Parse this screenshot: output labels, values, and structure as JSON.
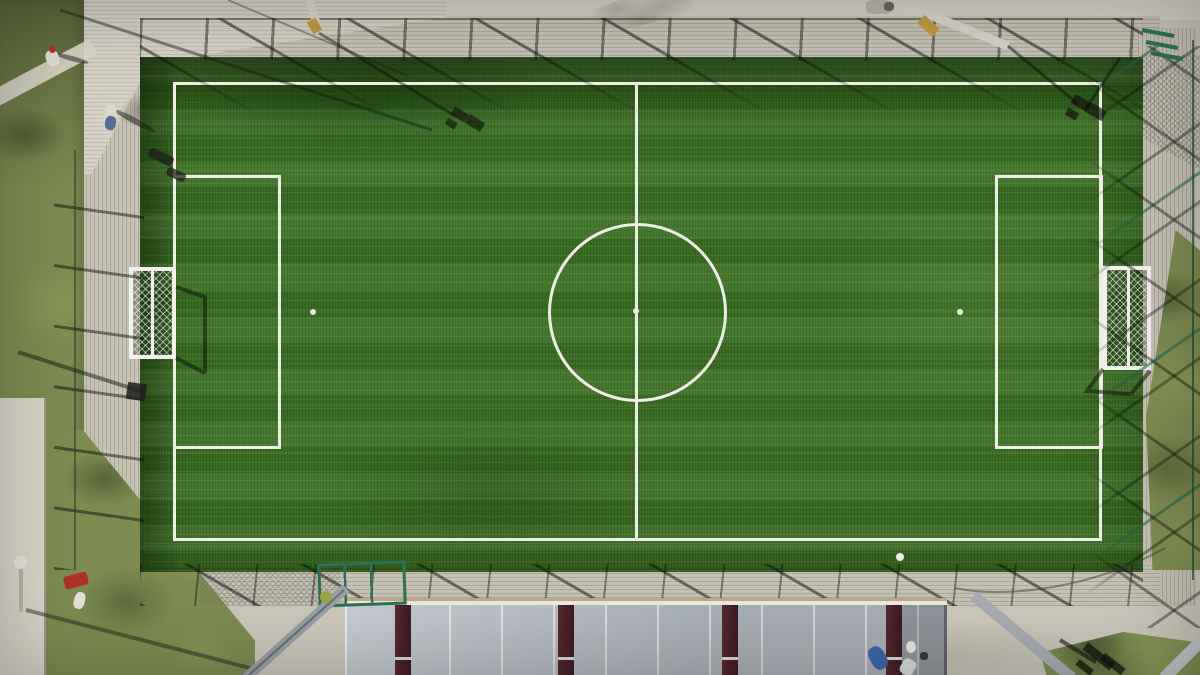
{
  "scene": {
    "description": "Top-down aerial drone photograph of an artificial-turf soccer pitch surrounded by a plank-textured concrete walkway, perimeter fences casting long diagonal shadows, lawn strips on the left and right, leaning floodlight masts, and a grey metal canopy roof with maroon beams along the bottom edge.",
    "field": {
      "bounds_px": {
        "left": 173,
        "top": 82,
        "right": 1102,
        "bottom": 541
      },
      "center_circle_radius_px": 89,
      "markings": [
        "touchlines",
        "halfway line",
        "center circle",
        "center spot",
        "left penalty area",
        "right penalty area",
        "left penalty spot",
        "right penalty spot",
        "left goal with net",
        "right goal with net"
      ]
    }
  },
  "colors": {
    "turf": "#3d7125",
    "line": "#edefe6",
    "goal": "#f2f3ec",
    "concrete": "#ccc8bc",
    "plaza": "#d6d2c6",
    "deck": "#c6c2b4",
    "path": "#dbd7ca",
    "grass": "#7e8c52",
    "roof": "#b7bec6",
    "fence_green": "#2d7057"
  },
  "objects": [
    {
      "name": "person-top-left-shadow",
      "x": 55,
      "y": 56,
      "w": 34,
      "h": 5,
      "color": "rgba(25,28,20,0.5)",
      "rotate": 15,
      "radius": "50%"
    },
    {
      "name": "person-top-left-shirt",
      "x": 46,
      "y": 50,
      "w": 13,
      "h": 16,
      "color": "#e3e1d6",
      "rotate": -20,
      "radius": "40%"
    },
    {
      "name": "person-top-left-cap",
      "x": 49,
      "y": 46,
      "w": 7,
      "h": 7,
      "color": "#b5352b",
      "radius": "50%"
    },
    {
      "name": "person-walkway-shadow",
      "x": 112,
      "y": 118,
      "w": 46,
      "h": 6,
      "color": "rgba(25,28,20,0.5)",
      "rotate": 28,
      "radius": "50%"
    },
    {
      "name": "person-walkway-body",
      "x": 104,
      "y": 104,
      "w": 12,
      "h": 26,
      "color": "#dad8cf",
      "rotate": 8,
      "radius": "40%"
    },
    {
      "name": "person-walkway-jacket",
      "x": 105,
      "y": 116,
      "w": 11,
      "h": 14,
      "color": "#5a6c96",
      "rotate": 8,
      "radius": "40%"
    },
    {
      "name": "bench-dark-1",
      "x": 148,
      "y": 152,
      "w": 26,
      "h": 10,
      "color": "rgba(30,32,26,0.8)",
      "rotate": 25,
      "radius": "3px"
    },
    {
      "name": "bench-dark-2",
      "x": 166,
      "y": 170,
      "w": 20,
      "h": 9,
      "color": "rgba(30,32,26,0.75)",
      "rotate": 25,
      "radius": "3px"
    },
    {
      "name": "bags-top-right",
      "x": 866,
      "y": 0,
      "w": 26,
      "h": 14,
      "color": "#b9b5a8",
      "radius": "30%"
    },
    {
      "name": "bag-dark-top-right",
      "x": 884,
      "y": 2,
      "w": 10,
      "h": 9,
      "color": "#6b675c",
      "radius": "40%"
    },
    {
      "name": "lamp-pole-bottom-left",
      "x": 19,
      "y": 566,
      "w": 4,
      "h": 46,
      "color": "#b9b6aa",
      "radius": "2px"
    },
    {
      "name": "lamp-head-bottom-left",
      "x": 14,
      "y": 556,
      "w": 13,
      "h": 13,
      "color": "#e8e6dd",
      "radius": "50%"
    },
    {
      "name": "red-utility-cart",
      "x": 64,
      "y": 574,
      "w": 24,
      "h": 13,
      "color": "#b03226",
      "rotate": -15,
      "radius": "3px"
    },
    {
      "name": "person-bottom-left",
      "x": 74,
      "y": 592,
      "w": 11,
      "h": 17,
      "color": "#e6e4da",
      "rotate": 15,
      "radius": "40%"
    },
    {
      "name": "soccer-ball",
      "x": 896,
      "y": 553,
      "w": 8,
      "h": 8,
      "color": "#eef0e8",
      "radius": "50%"
    },
    {
      "name": "person-blue-jacket",
      "x": 870,
      "y": 646,
      "w": 16,
      "h": 24,
      "color": "#3c66a8",
      "rotate": -30,
      "radius": "40%"
    },
    {
      "name": "person-white-cap",
      "x": 906,
      "y": 641,
      "w": 10,
      "h": 12,
      "color": "#e9e7df",
      "radius": "50%"
    },
    {
      "name": "person-striped-shirt",
      "x": 901,
      "y": 659,
      "w": 14,
      "h": 16,
      "color": "#d8d8d4",
      "rotate": 30,
      "radius": "30%"
    },
    {
      "name": "bag-dark-bottom",
      "x": 920,
      "y": 652,
      "w": 8,
      "h": 8,
      "color": "#3a3b33",
      "radius": "40%"
    }
  ]
}
